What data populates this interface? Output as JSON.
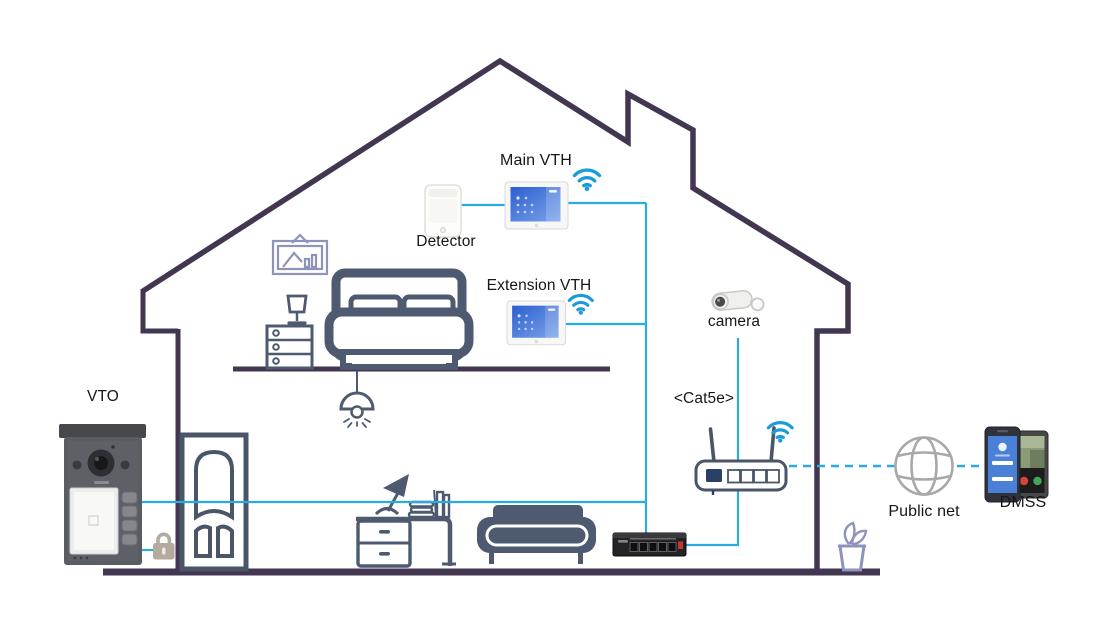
{
  "labels": {
    "vto": "VTO",
    "main_vth": "Main VTH",
    "detector": "Detector",
    "extension_vth": "Extension VTH",
    "camera": "camera",
    "cat5e": "<Cat5e>",
    "public_net": "Public net",
    "dmss": "DMSS"
  },
  "colors": {
    "connection_line": "#29abe2",
    "wifi_icon": "#1a9cd8",
    "house_outline": "#423651",
    "furniture": "#4e5a70",
    "frame_and_plant": "#8d93bb",
    "lock": "#b2ab9e",
    "globe": "#a8a8a8",
    "vth_screen": "#3a6fd8",
    "label_text": "#161616"
  },
  "devices": [
    {
      "id": "vto",
      "label": "VTO"
    },
    {
      "id": "detector",
      "label": "Detector"
    },
    {
      "id": "main-vth",
      "label": "Main VTH",
      "wifi": true
    },
    {
      "id": "extension-vth",
      "label": "Extension VTH",
      "wifi": true
    },
    {
      "id": "camera",
      "label": "camera"
    },
    {
      "id": "cable",
      "label": "<Cat5e>"
    },
    {
      "id": "router",
      "wifi": true
    },
    {
      "id": "switch"
    },
    {
      "id": "door-lock"
    },
    {
      "id": "public-net",
      "label": "Public net"
    },
    {
      "id": "dmss-app",
      "label": "DMSS"
    }
  ]
}
